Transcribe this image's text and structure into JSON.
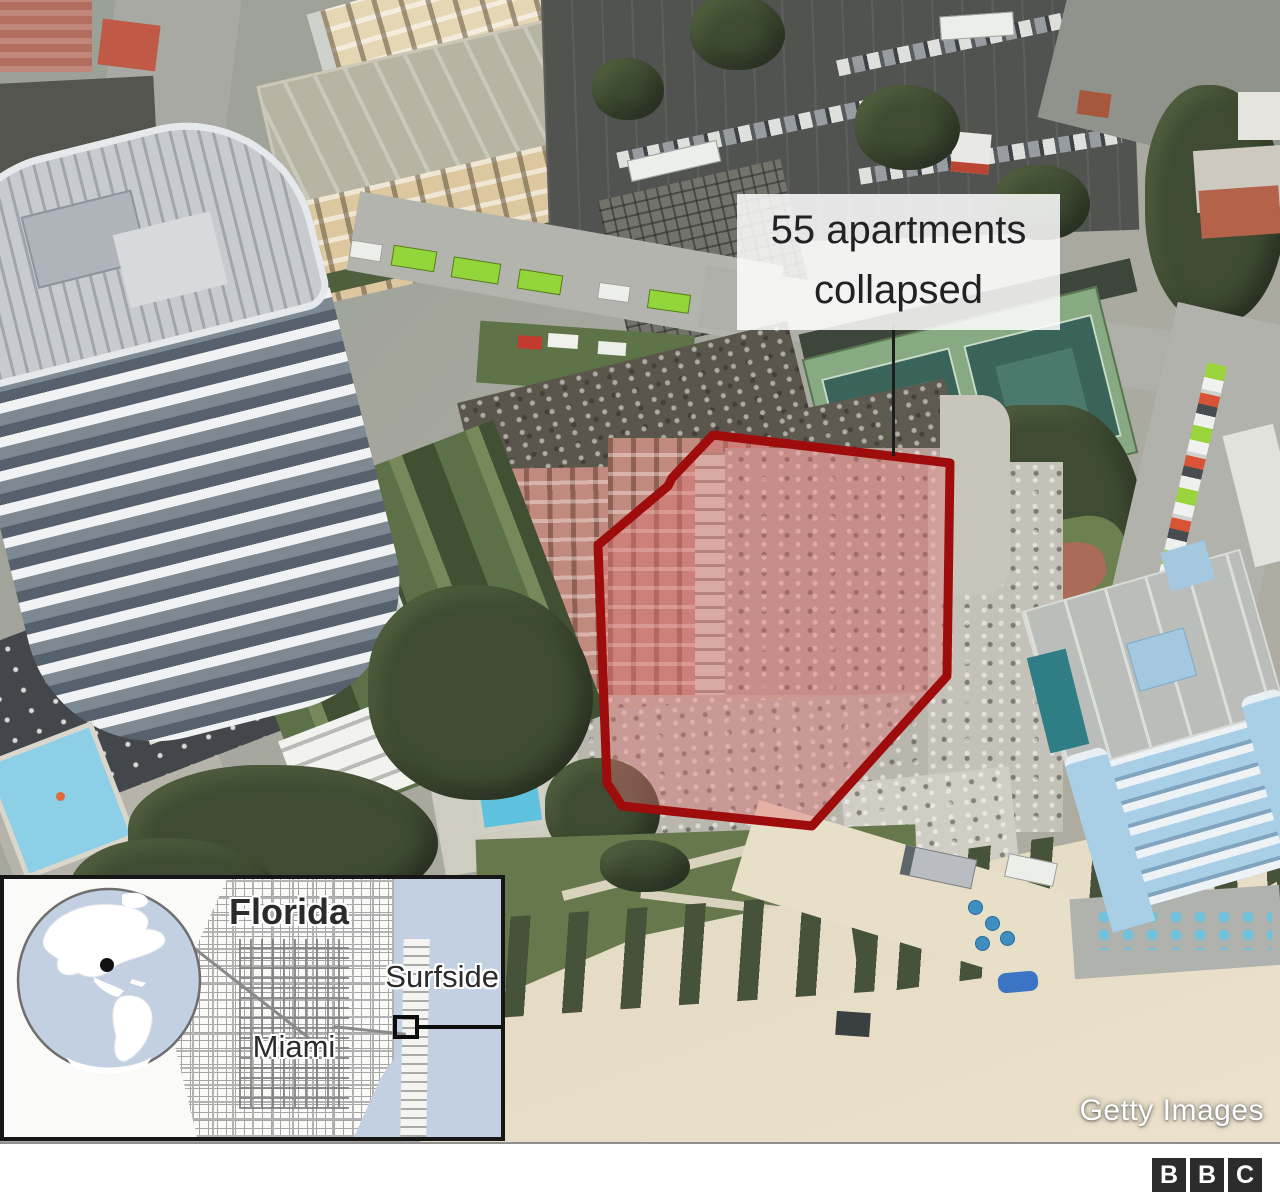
{
  "graphic": {
    "callout": {
      "line1": "55 apartments",
      "line2": "collapsed"
    },
    "credit": "Getty Images"
  },
  "highlight": {
    "stroke_color": "#9e0c0c",
    "fill_color": "rgba(222,115,115,0.42)"
  },
  "inset_map": {
    "state_label": "Florida",
    "town_label": "Surfside",
    "city_label": "Miami",
    "water_color": "#c3d0e1",
    "land_color": "#ffffff"
  },
  "footer": {
    "logo_letters": [
      "B",
      "B",
      "C"
    ]
  }
}
